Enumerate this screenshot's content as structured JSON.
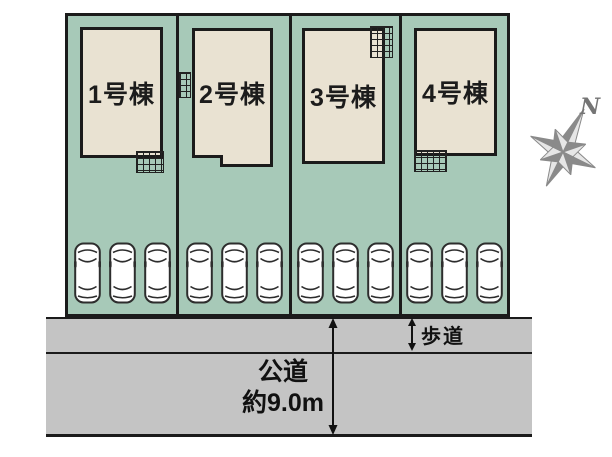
{
  "site": {
    "lots": [
      {
        "label": "1号棟"
      },
      {
        "label": "2号棟"
      },
      {
        "label": "3号棟"
      },
      {
        "label": "4号棟"
      }
    ],
    "parking": {
      "cars_per_lot": 3
    }
  },
  "annotations": {
    "sidewalk_label": "歩道",
    "road_name": "公道",
    "road_width": "約9.0m"
  },
  "compass": {
    "label": "N"
  },
  "colors": {
    "lot_green": "#a7c9b8",
    "building_fill": "#e9e2d2",
    "outline": "#1b1b1b",
    "road_gray": "#c4c4c4",
    "compass_gray": "#8a8a8a"
  }
}
